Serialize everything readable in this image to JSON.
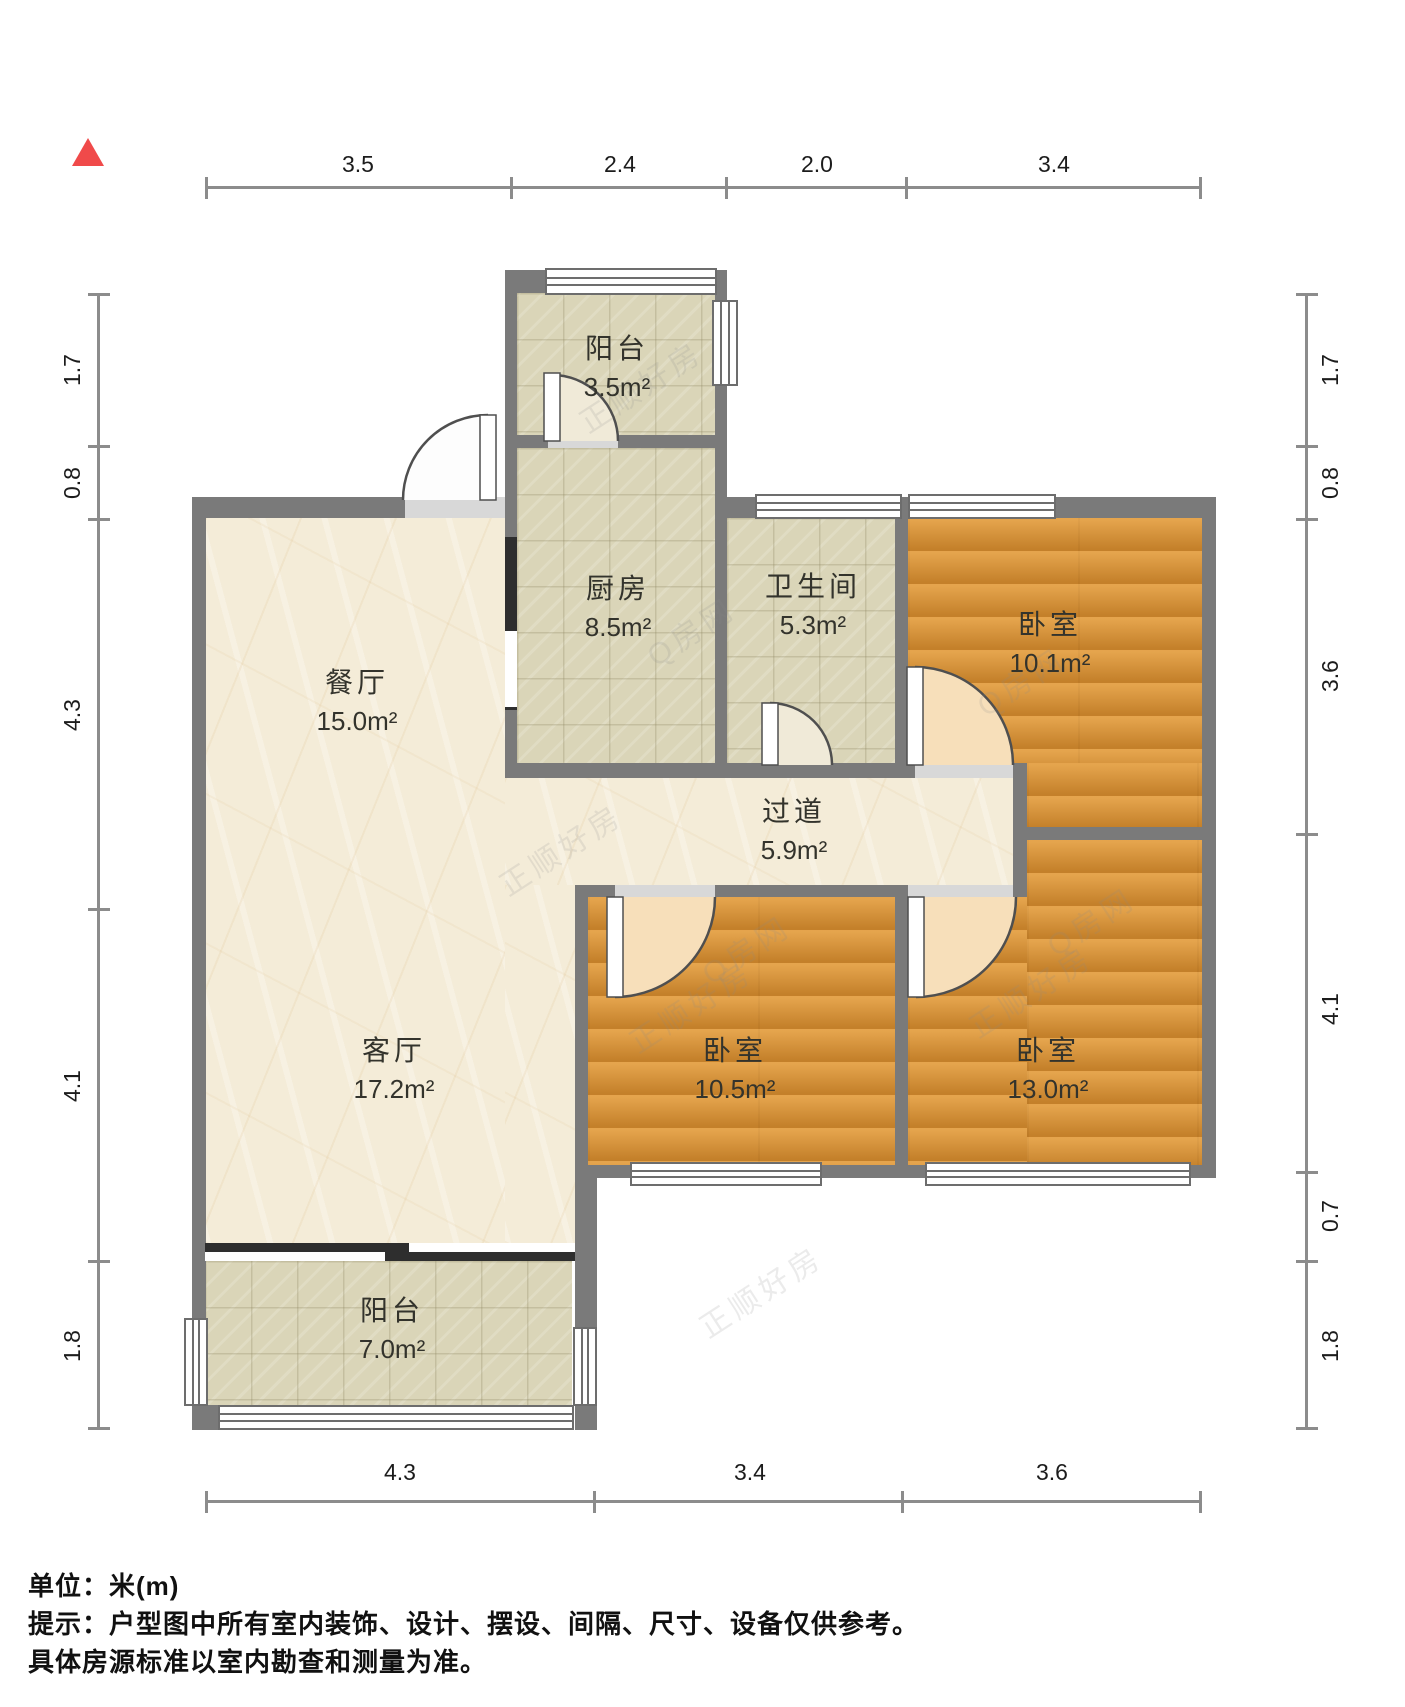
{
  "rooms": {
    "balcony_top": {
      "name": "阳台",
      "area": "3.5m²"
    },
    "kitchen": {
      "name": "厨房",
      "area": "8.5m²"
    },
    "bathroom": {
      "name": "卫生间",
      "area": "5.3m²"
    },
    "bedroom_top_right": {
      "name": "卧室",
      "area": "10.1m²"
    },
    "dining": {
      "name": "餐厅",
      "area": "15.0m²"
    },
    "hallway": {
      "name": "过道",
      "area": "5.9m²"
    },
    "living": {
      "name": "客厅",
      "area": "17.2m²"
    },
    "bedroom_bottom_middle": {
      "name": "卧室",
      "area": "10.5m²"
    },
    "bedroom_bottom_right": {
      "name": "卧室",
      "area": "13.0m²"
    },
    "balcony_bottom": {
      "name": "阳台",
      "area": "7.0m²"
    }
  },
  "dimensions": {
    "top": [
      "3.5",
      "2.4",
      "2.0",
      "3.4"
    ],
    "bottom": [
      "4.3",
      "3.4",
      "3.6"
    ],
    "left": [
      "1.7",
      "0.8",
      "4.3",
      "4.1",
      "1.8"
    ],
    "right": [
      "1.7",
      "0.8",
      "3.6",
      "4.1",
      "0.7",
      "1.8"
    ]
  },
  "watermark": {
    "brand": "正顺好房",
    "site": "Q房网"
  },
  "footer": {
    "unit": "单位：米(m)",
    "tip": "提示：户型图中所有室内装饰、设计、摆设、间隔、尺寸、设备仅供参考。",
    "note": "具体房源标准以室内勘查和测量为准。"
  },
  "colors": {
    "north_marker": "#f04a4a",
    "wall": "#7a7a7a",
    "wall_dark": "#2e2e2e",
    "marble_floor": "#f4ecd8",
    "tile_floor": "#dad5b8",
    "wood_floor": "#db9335",
    "dim_line": "#8c8c8c"
  }
}
